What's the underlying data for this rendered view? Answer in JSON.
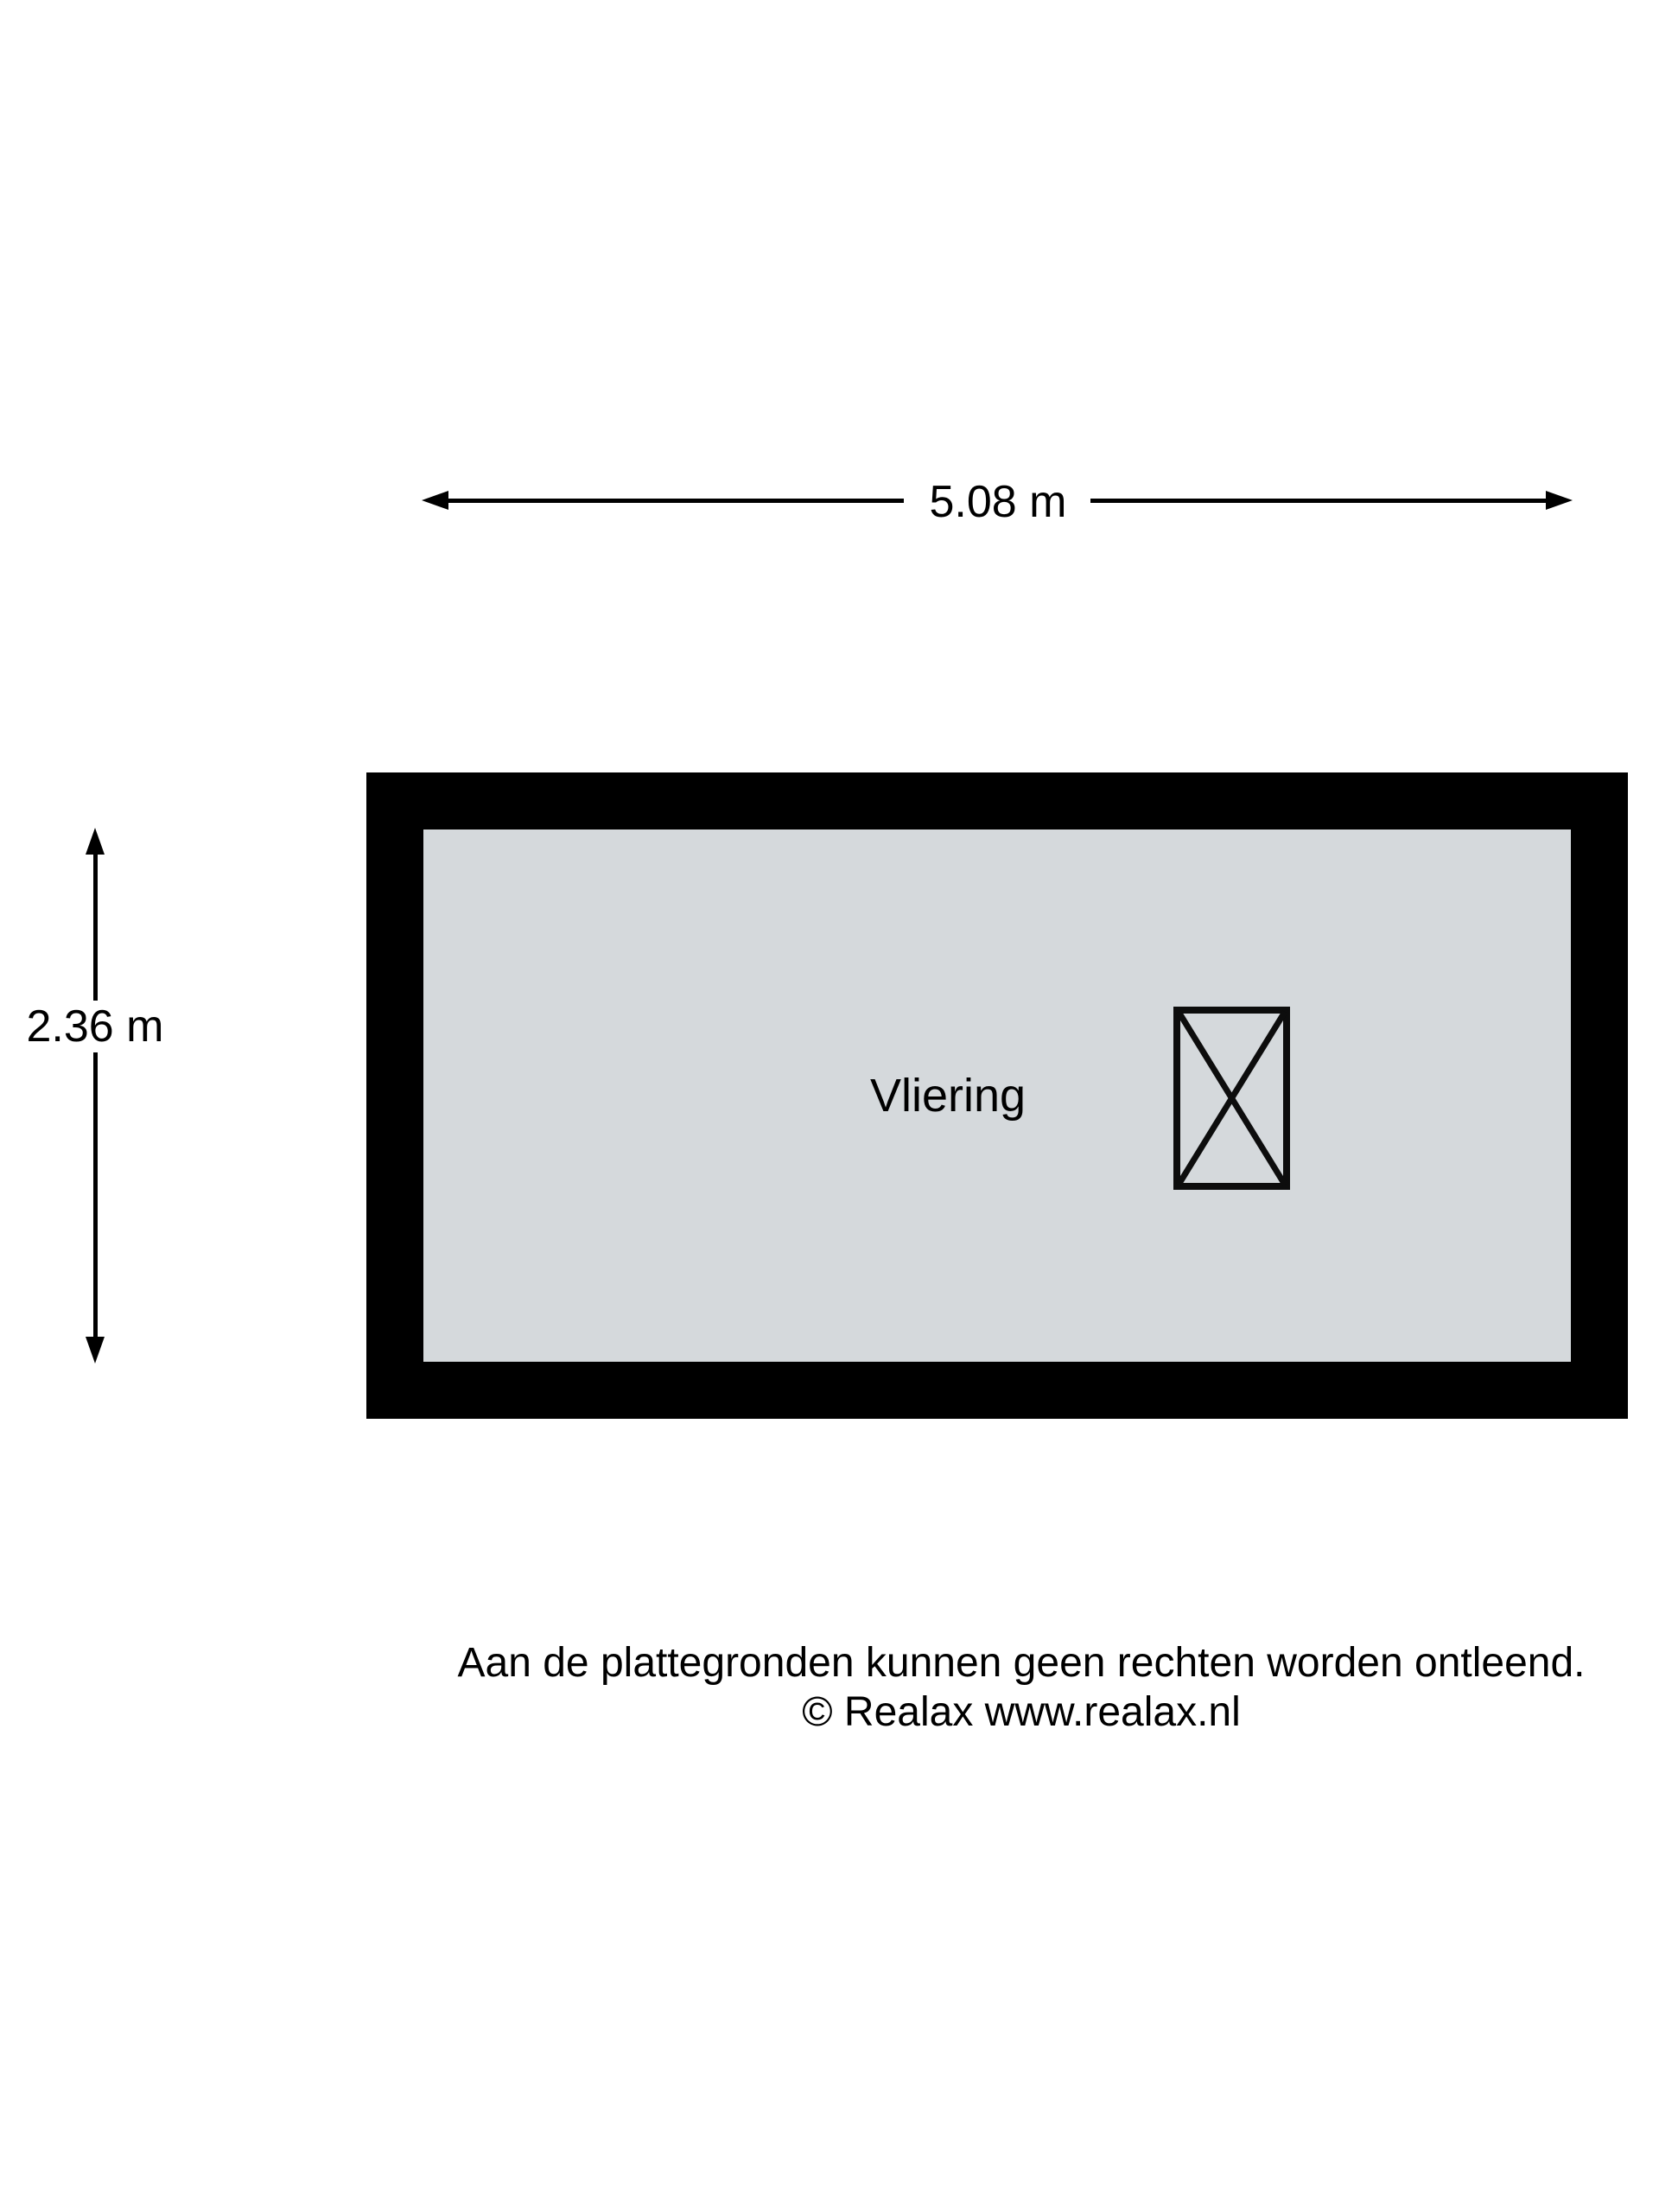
{
  "floorplan": {
    "room": {
      "label": "Vliering"
    },
    "dimensions": {
      "width_label": "5.08 m",
      "height_label": "2.36 m"
    },
    "symbols": {
      "hatch_icon": "crossed-rectangle-opening"
    },
    "colors": {
      "wall": "#000000",
      "floor_fill": "#d5d9dc",
      "line": "#000000",
      "background": "#ffffff"
    }
  },
  "footer": {
    "disclaimer": "Aan de plattegronden kunnen geen rechten worden ontleend.",
    "copyright": "© Realax www.realax.nl"
  }
}
